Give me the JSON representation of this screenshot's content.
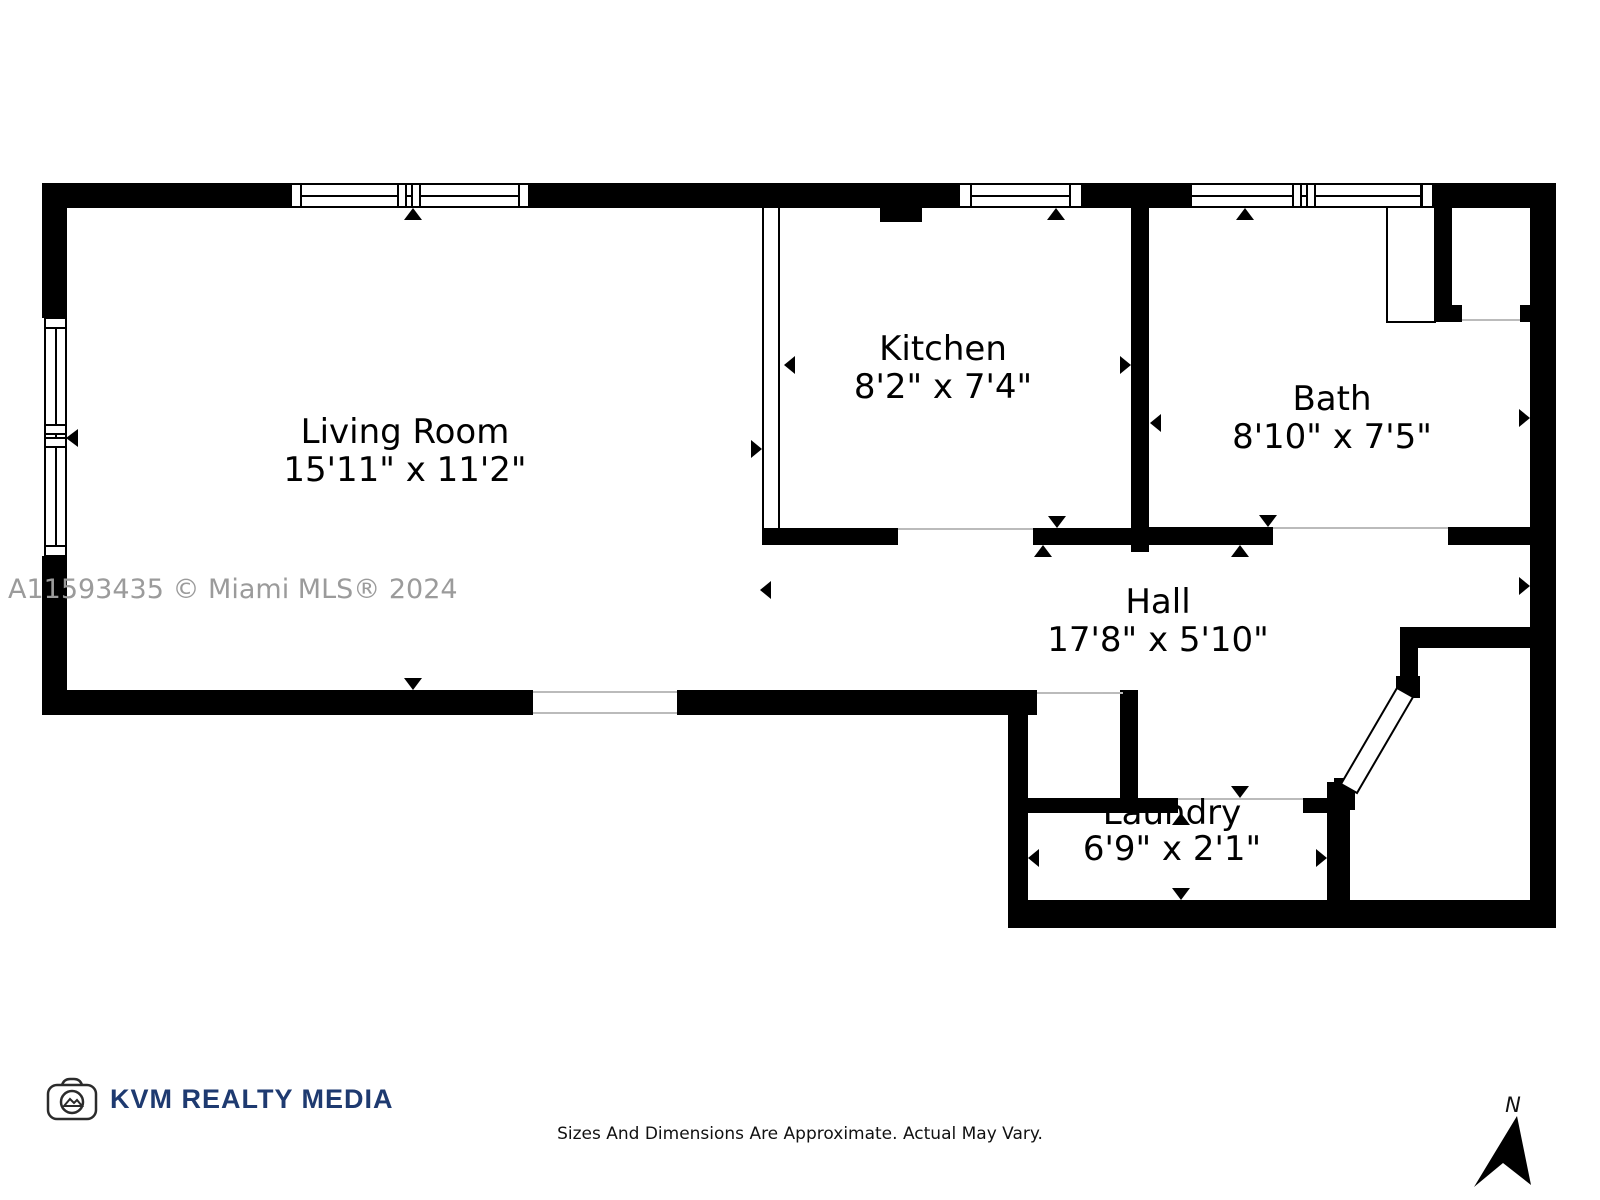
{
  "rooms": [
    {
      "name": "Living Room",
      "dimensions": "15'11\" x 11'2\""
    },
    {
      "name": "Kitchen",
      "dimensions": "8'2\" x 7'4\""
    },
    {
      "name": "Bath",
      "dimensions": "8'10\" x 7'5\""
    },
    {
      "name": "Hall",
      "dimensions": "17'8\" x 5'10\""
    },
    {
      "name": "Laundry",
      "dimensions": "6'9\" x 2'1\""
    }
  ],
  "watermark": "A11593435 © Miami MLS® 2024",
  "branding": {
    "logo_icon": "camera-icon",
    "logo_text": "KVM REALTY MEDIA",
    "brand_color": "#1e3a70"
  },
  "disclaimer": "Sizes And Dimensions Are Approximate. Actual May Vary.",
  "compass": {
    "label": "N"
  },
  "colors": {
    "wall": "#000000",
    "watermark": "#9b9b9b",
    "threshold": "#bbbbbb"
  }
}
